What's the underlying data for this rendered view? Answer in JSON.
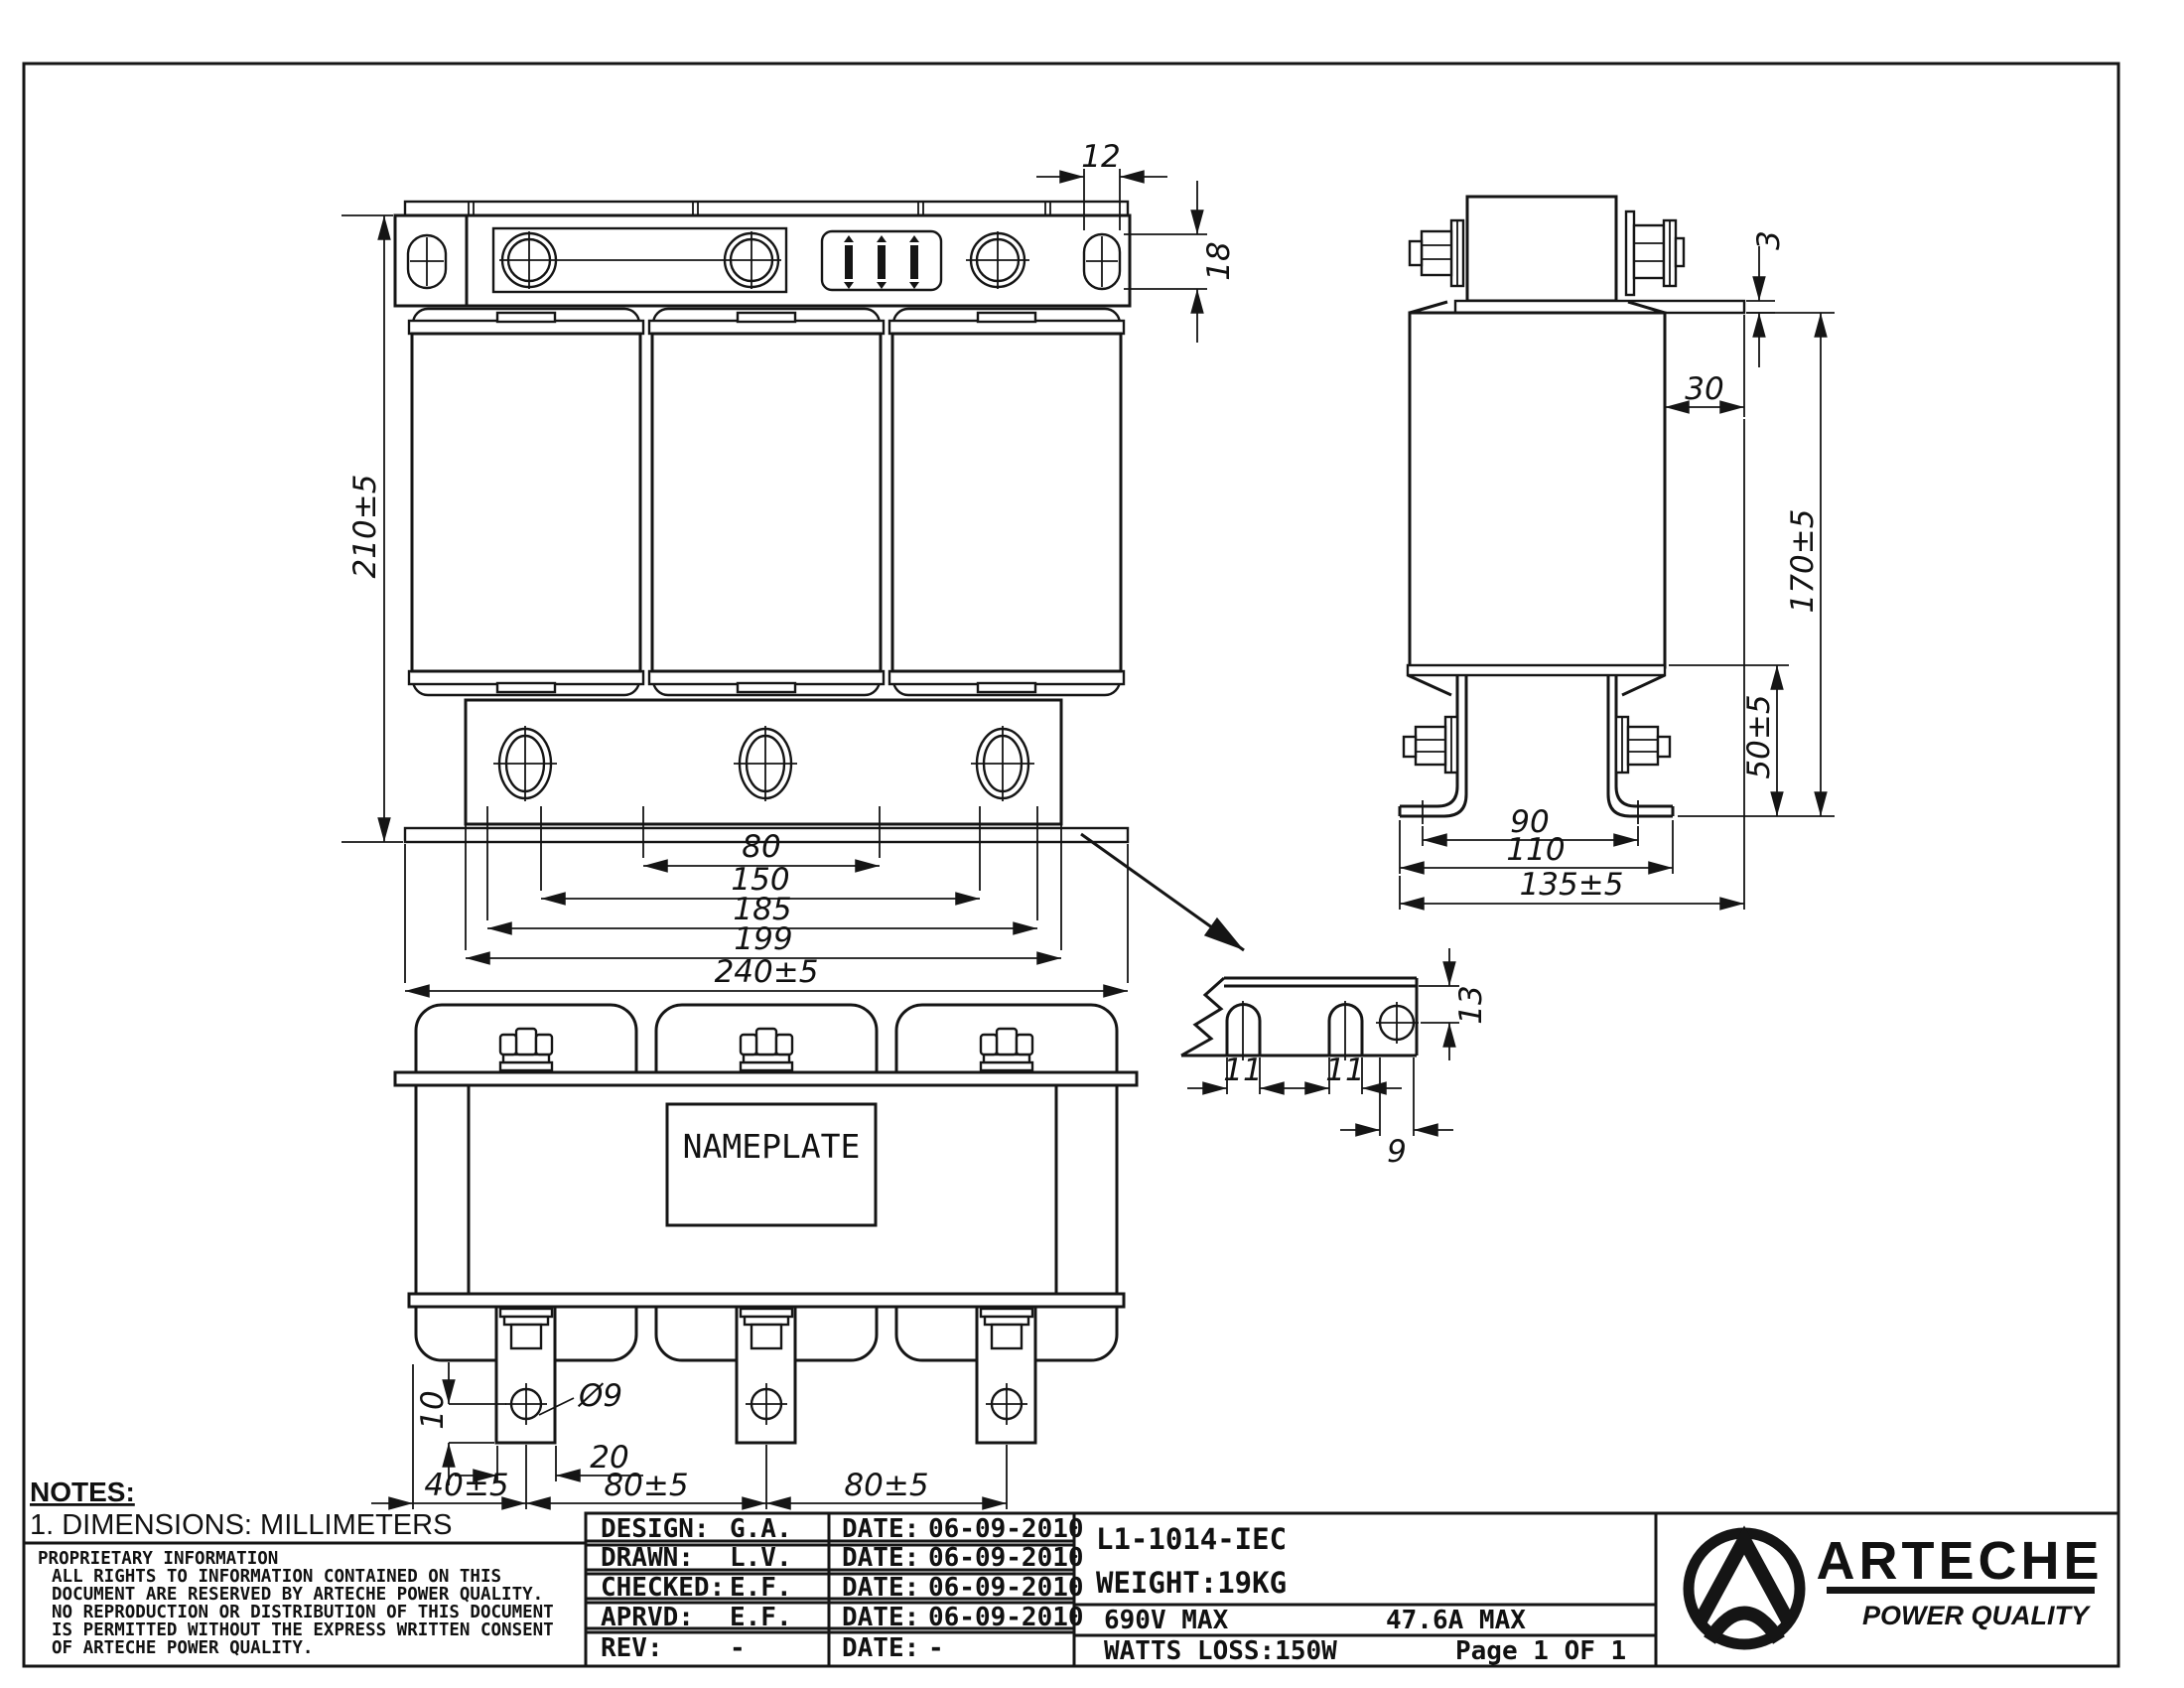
{
  "notes": {
    "heading": "NOTES:",
    "dimension_note": "1. DIMENSIONS: MILLIMETERS",
    "proprietary": [
      "PROPRIETARY INFORMATION",
      "ALL RIGHTS TO INFORMATION CONTAINED ON THIS",
      "DOCUMENT ARE RESERVED BY ARTECHE POWER QUALITY.",
      "NO REPRODUCTION OR DISTRIBUTION OF THIS DOCUMENT",
      "IS PERMITTED WITHOUT THE EXPRESS WRITTEN CONSENT",
      "OF ARTECHE POWER QUALITY."
    ]
  },
  "title_block": {
    "rows": [
      {
        "label": "DESIGN:",
        "value": "G.A.",
        "date_label": "DATE:",
        "date": "06-09-2010"
      },
      {
        "label": "DRAWN:",
        "value": "L.V.",
        "date_label": "DATE:",
        "date": "06-09-2010"
      },
      {
        "label": "CHECKED:",
        "value": "E.F.",
        "date_label": "DATE:",
        "date": "06-09-2010"
      },
      {
        "label": "APRVD:",
        "value": "E.F.",
        "date_label": "DATE:",
        "date": "06-09-2010"
      },
      {
        "label": "REV:",
        "value": "-",
        "date_label": "DATE:",
        "date": "-"
      }
    ],
    "part_number": "L1-1014-IEC",
    "weight": "WEIGHT:19KG",
    "voltage": "690V MAX",
    "current": "47.6A MAX",
    "watts_loss": "WATTS LOSS:150W",
    "page": "Page 1 OF 1"
  },
  "logo": {
    "brand": "ARTECHE",
    "tagline": "POWER QUALITY"
  },
  "views": {
    "front": {
      "dims": {
        "slot_width": "12",
        "slot_height": "18",
        "height": "210±5",
        "chain": [
          "80",
          "150",
          "185",
          "199",
          "240±5"
        ]
      }
    },
    "side": {
      "dims": {
        "plate_lip": "3",
        "offset": "30",
        "height": "170±5",
        "bracket_height": "50±5",
        "hole_spacing": "90",
        "foot_width": "110",
        "depth": "135±5"
      }
    },
    "rear": {
      "nameplate": "NAMEPLATE",
      "dims": {
        "hole_edge": "10",
        "hole_dia": "Ø9",
        "lug_width": "20",
        "pitch_first": "40±5",
        "pitch_a": "80±5",
        "pitch_b": "80±5"
      }
    },
    "detail": {
      "dims": {
        "slot_a": "11",
        "slot_b": "11",
        "hole_depth": "13",
        "hole_width": "9"
      }
    }
  }
}
